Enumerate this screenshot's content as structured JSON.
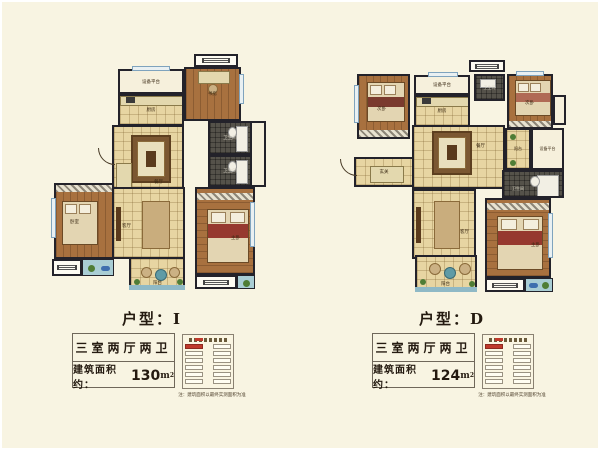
{
  "palette": {
    "background": "#f8f4e2",
    "wall": "#23222a",
    "wood_floor": "#a8713f",
    "tile_floor": "#e7d5a2",
    "bath_tile": "#55524a",
    "window_blue": "#7fa3bd",
    "balcony_teal": "#8fb9c6",
    "title_text": "#241a10",
    "keyplan_highlight": "#c0392b"
  },
  "plans": [
    {
      "unit": "I",
      "title_label": "户型：",
      "title_value": "I",
      "spec": "三室两厅两卫",
      "area_label": "建筑面积约：",
      "area_number": "130",
      "area_unit": "m",
      "area_sup": "2",
      "note": "注：建筑面积以最终实测面积为准",
      "rooms": {
        "equipment": "设备平台",
        "kitchen": "厨房",
        "study": "书房",
        "dining": "餐厅",
        "bath1": "卫生间",
        "bath2": "卫生间",
        "bedroom": "卧室",
        "living": "客厅",
        "master": "主卧",
        "balcony": "阳台"
      }
    },
    {
      "unit": "D",
      "title_label": "户型：",
      "title_value": "D",
      "spec": "三室两厅两卫",
      "area_label": "建筑面积约：",
      "area_number": "124",
      "area_unit": "m",
      "area_sup": "2",
      "note": "注：建筑面积以最终实测面积为准",
      "rooms": {
        "bedroom2a": "次卧",
        "equipment1": "设备平台",
        "kitchen": "厨房",
        "bath1": "卫生间",
        "bedroom2b": "次卧",
        "dining": "餐厅",
        "balcony_side": "阳台",
        "equipment2": "设备平台",
        "entry": "玄关",
        "bath2": "卫生间",
        "living": "客厅",
        "master": "主卧",
        "balcony": "阳台"
      }
    }
  ]
}
